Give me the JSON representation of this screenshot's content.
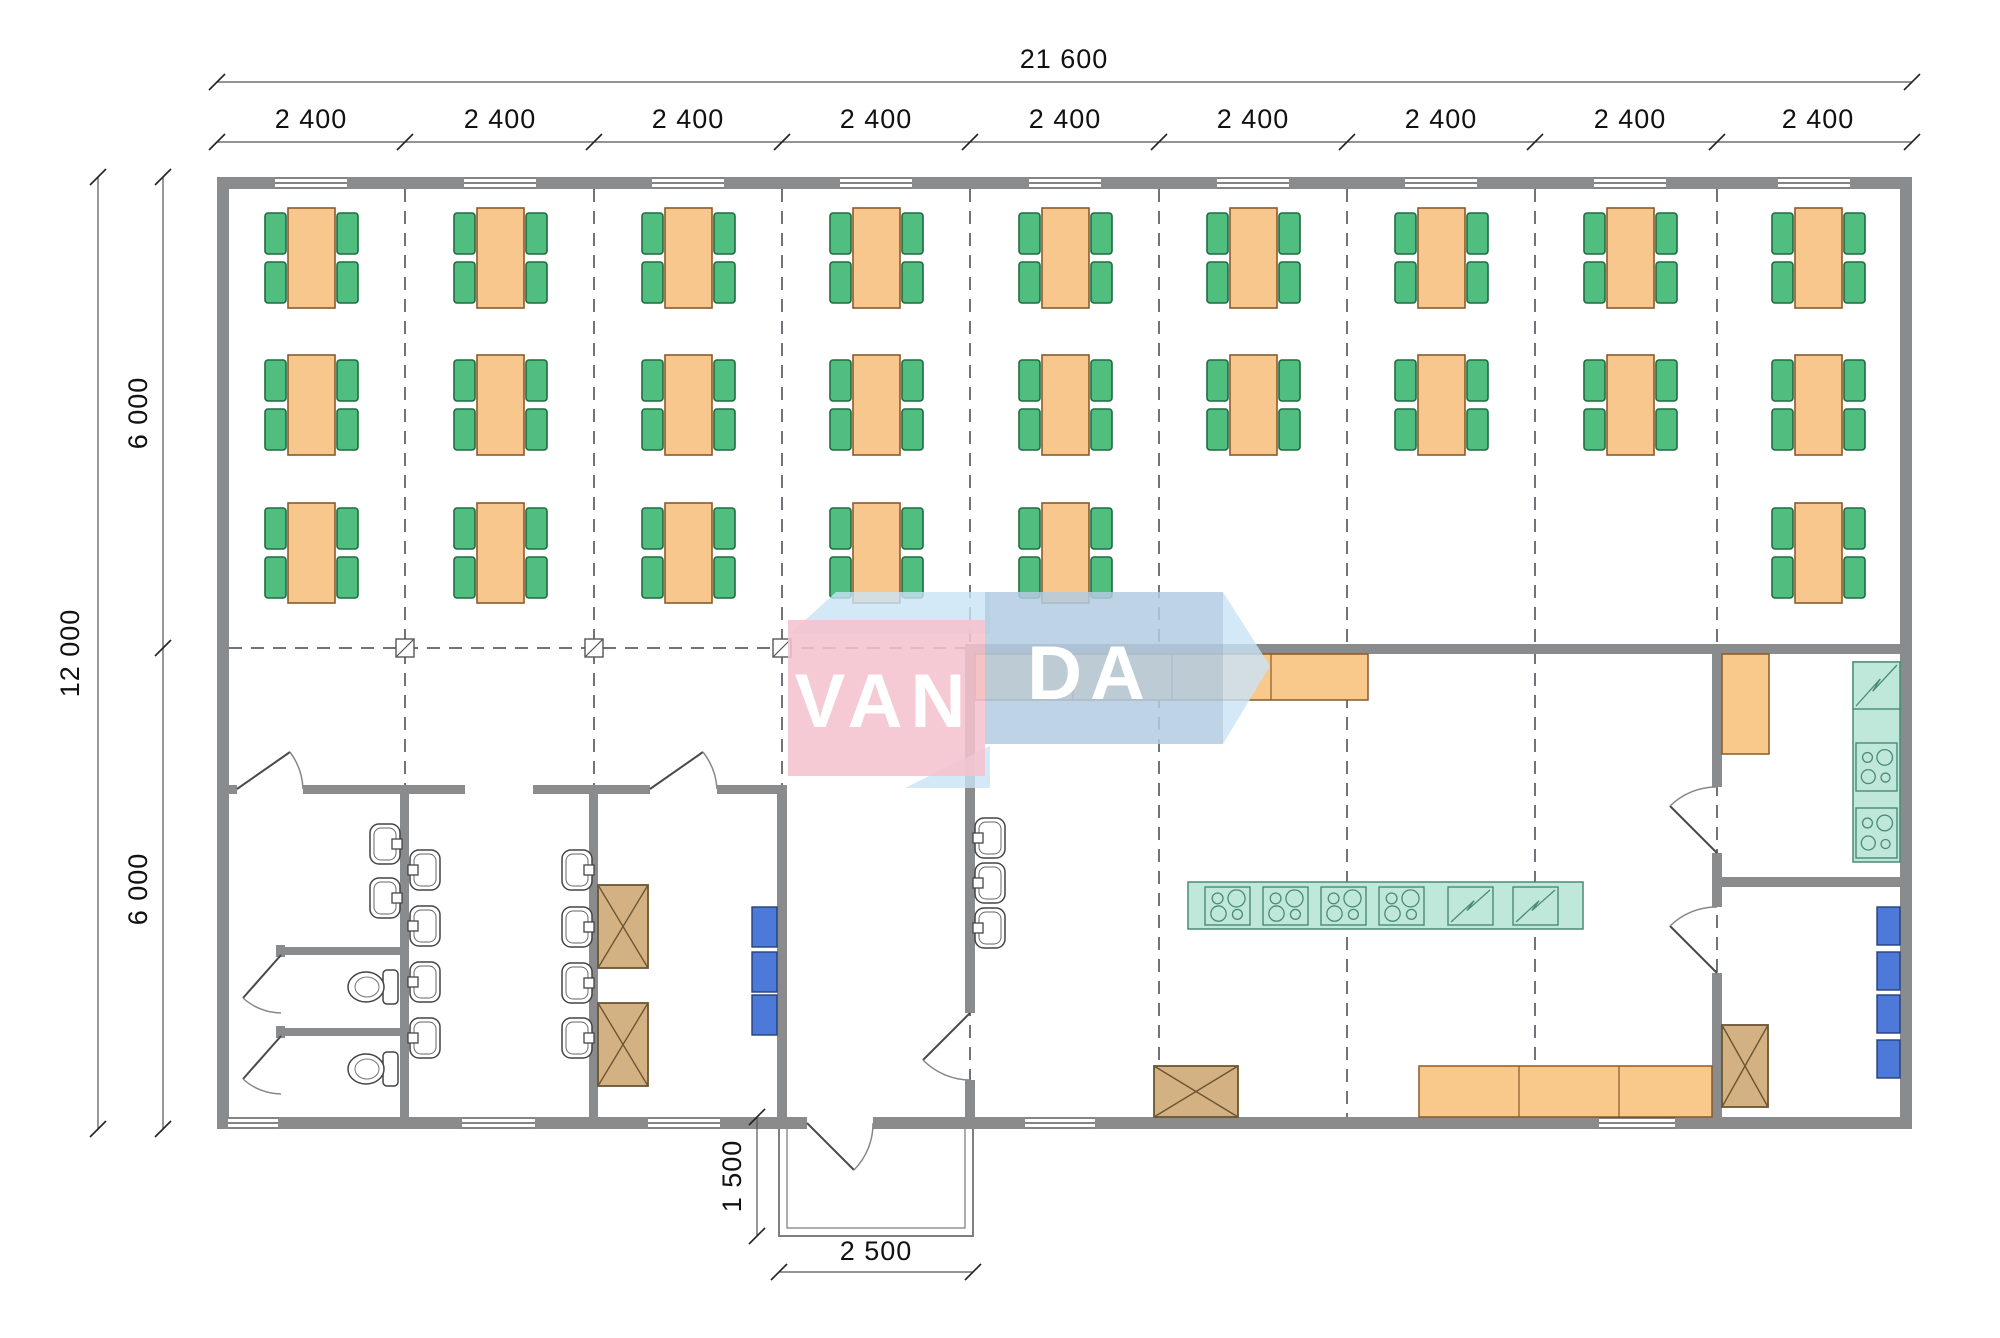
{
  "drawing": {
    "type": "architectural floor plan",
    "description": "Canteen / dining hall module plan with dining area, washrooms, vestibule, kitchen and utility rooms"
  },
  "watermark": {
    "left": "VAN",
    "right": "DA"
  },
  "dimensions": {
    "total_width": "21 600",
    "bays": [
      "2 400",
      "2 400",
      "2 400",
      "2 400",
      "2 400",
      "2 400",
      "2 400",
      "2 400",
      "2 400"
    ],
    "total_height": "12 000",
    "half_heights": [
      "6 000",
      "6 000"
    ],
    "porch_depth": "1 500",
    "porch_width": "2 500"
  },
  "colors": {
    "wall": "#8a8b8d",
    "table": "#f7c78e",
    "table_border": "#8a5a2a",
    "chair": "#4fbe7e",
    "chair_border": "#1f6b41",
    "counter": "#f9c98c",
    "counter_border": "#8a5a2a",
    "teal": "#bfe8da",
    "teal_border": "#4a8a77",
    "blue_box": "#4d79d8",
    "blue_box_border": "#24407c",
    "tan": "#d3b183",
    "tan_border": "#6b5533",
    "grid": "#6f7478",
    "fixture_line": "#3a3f44",
    "watermark_pink": "#f5c2ce",
    "watermark_blue": "#b3cbe2",
    "watermark_light": "#c8e4f6"
  },
  "furniture": {
    "table": {
      "w": 47,
      "h": 100
    },
    "chair": {
      "w": 21,
      "h": 41
    },
    "dining_sets": [
      [
        288,
        208
      ],
      [
        477,
        208
      ],
      [
        665,
        208
      ],
      [
        853,
        208
      ],
      [
        1042,
        208
      ],
      [
        1230,
        208
      ],
      [
        1418,
        208
      ],
      [
        1607,
        208
      ],
      [
        1795,
        208
      ],
      [
        288,
        355
      ],
      [
        477,
        355
      ],
      [
        665,
        355
      ],
      [
        853,
        355
      ],
      [
        1042,
        355
      ],
      [
        1230,
        355
      ],
      [
        1418,
        355
      ],
      [
        1607,
        355
      ],
      [
        1795,
        355
      ],
      [
        288,
        503
      ],
      [
        477,
        503
      ],
      [
        665,
        503
      ],
      [
        853,
        503
      ],
      [
        1042,
        503
      ],
      [
        1795,
        503
      ]
    ],
    "counters": [
      {
        "x": 975,
        "y": 654,
        "w": 393,
        "h": 46,
        "dividers": [
          1073,
          1172,
          1271
        ]
      },
      {
        "x": 1419,
        "y": 1066,
        "w": 293,
        "h": 51,
        "dividers": [
          1519,
          1619
        ]
      },
      {
        "x": 1722,
        "y": 654,
        "w": 47,
        "h": 100,
        "dividers": []
      }
    ],
    "island": {
      "x": 1188,
      "y": 882,
      "w": 395,
      "h": 47
    },
    "teal_counter": {
      "x": 1853,
      "y": 662,
      "w": 47,
      "h": 200
    },
    "stoves": [
      {
        "x": 1205,
        "y": 887,
        "w": 45,
        "h": 38
      },
      {
        "x": 1263,
        "y": 887,
        "w": 45,
        "h": 38
      },
      {
        "x": 1321,
        "y": 887,
        "w": 45,
        "h": 38
      },
      {
        "x": 1379,
        "y": 887,
        "w": 45,
        "h": 38
      },
      {
        "x": 1856,
        "y": 743,
        "w": 41,
        "h": 48
      },
      {
        "x": 1856,
        "y": 808,
        "w": 41,
        "h": 50
      }
    ],
    "sink_units": [
      {
        "x": 1448,
        "y": 887,
        "w": 45,
        "h": 38
      },
      {
        "x": 1513,
        "y": 887,
        "w": 45,
        "h": 38
      },
      {
        "x": 1853,
        "y": 662,
        "w": 47,
        "h": 47
      }
    ],
    "basin_size": {
      "w": 30,
      "h": 40
    },
    "basins": [
      {
        "x": 370,
        "y": 824,
        "f": "r"
      },
      {
        "x": 370,
        "y": 878,
        "f": "r"
      },
      {
        "x": 410,
        "y": 850,
        "f": "l"
      },
      {
        "x": 410,
        "y": 906,
        "f": "l"
      },
      {
        "x": 410,
        "y": 962,
        "f": "l"
      },
      {
        "x": 410,
        "y": 1018,
        "f": "l"
      },
      {
        "x": 562,
        "y": 850,
        "f": "r"
      },
      {
        "x": 562,
        "y": 907,
        "f": "r"
      },
      {
        "x": 562,
        "y": 963,
        "f": "r"
      },
      {
        "x": 562,
        "y": 1018,
        "f": "r"
      },
      {
        "x": 975,
        "y": 818,
        "f": "l"
      },
      {
        "x": 975,
        "y": 863,
        "f": "l"
      },
      {
        "x": 975,
        "y": 908,
        "f": "l"
      }
    ],
    "toilets": [
      {
        "cx": 366,
        "cy": 987
      },
      {
        "cx": 366,
        "cy": 1069
      }
    ],
    "x_boxes": [
      {
        "x": 598,
        "y": 885,
        "w": 50,
        "h": 83
      },
      {
        "x": 598,
        "y": 1003,
        "w": 50,
        "h": 83
      },
      {
        "x": 1154,
        "y": 1066,
        "w": 84,
        "h": 51
      },
      {
        "x": 1722,
        "y": 1025,
        "w": 46,
        "h": 82
      }
    ],
    "blue_boxes": [
      {
        "x": 752,
        "y": 907,
        "w": 25,
        "h": 40
      },
      {
        "x": 752,
        "y": 952,
        "w": 25,
        "h": 40
      },
      {
        "x": 752,
        "y": 995,
        "w": 25,
        "h": 40
      },
      {
        "x": 1877,
        "y": 907,
        "w": 23,
        "h": 38
      },
      {
        "x": 1877,
        "y": 952,
        "w": 23,
        "h": 38
      },
      {
        "x": 1877,
        "y": 995,
        "w": 23,
        "h": 38
      },
      {
        "x": 1877,
        "y": 1040,
        "w": 23,
        "h": 38
      }
    ]
  },
  "openings": {
    "windows_top_y": 177,
    "windows_top": [
      275,
      464,
      652,
      840,
      1029,
      1217,
      1405,
      1594,
      1778
    ],
    "windows_top_w": 72,
    "windows_bottom_y": 1117,
    "windows_bottom": [
      {
        "x": 228,
        "w": 50
      },
      {
        "x": 462,
        "w": 73
      },
      {
        "x": 648,
        "w": 72
      },
      {
        "x": 1025,
        "w": 70
      },
      {
        "x": 1599,
        "w": 76
      }
    ]
  },
  "grid": {
    "vlines": [
      405,
      594,
      782,
      970,
      1159,
      1347,
      1535,
      1717
    ],
    "v_y1": 189,
    "v_y2": 1117,
    "hline": {
      "y": 648,
      "x1": 229,
      "x2": 965
    },
    "columns": [
      405,
      594,
      782
    ]
  }
}
